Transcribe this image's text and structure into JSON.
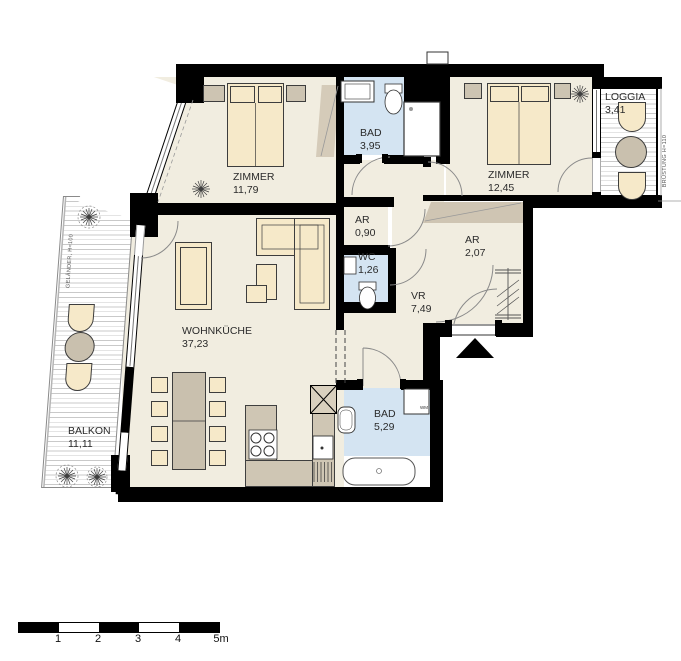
{
  "rooms": [
    {
      "id": "zimmer1",
      "name": "ZIMMER",
      "area": "11,79"
    },
    {
      "id": "bad1",
      "name": "BAD",
      "area": "3,95"
    },
    {
      "id": "zimmer2",
      "name": "ZIMMER",
      "area": "12,45"
    },
    {
      "id": "loggia",
      "name": "LOGGIA",
      "area": "3,41"
    },
    {
      "id": "ar1",
      "name": "AR",
      "area": "0,90"
    },
    {
      "id": "wc",
      "name": "WC",
      "area": "1,26"
    },
    {
      "id": "ar2",
      "name": "AR",
      "area": "2,07"
    },
    {
      "id": "vr",
      "name": "VR",
      "area": "7,49"
    },
    {
      "id": "wohnkueche",
      "name": "WOHNKÜCHE",
      "area": "37,23"
    },
    {
      "id": "balkon",
      "name": "BALKON",
      "area": "11,11"
    },
    {
      "id": "bad2",
      "name": "BAD",
      "area": "5,29"
    }
  ],
  "annotations": {
    "balcony_railing": "GELÄNDER, H=100",
    "loggia_parapet": "BRÜSTUNG H=110",
    "washing_machine": "WM"
  },
  "scale_bar": {
    "labels": [
      "1",
      "2",
      "3",
      "4",
      "5m"
    ]
  },
  "colors": {
    "wall": "#000000",
    "floor": "#F1EDE0",
    "wet_room": "#D4E4F2",
    "furniture": "#F6E9C9",
    "wood": "#CDC4B2",
    "text": "#2b2b2b"
  }
}
